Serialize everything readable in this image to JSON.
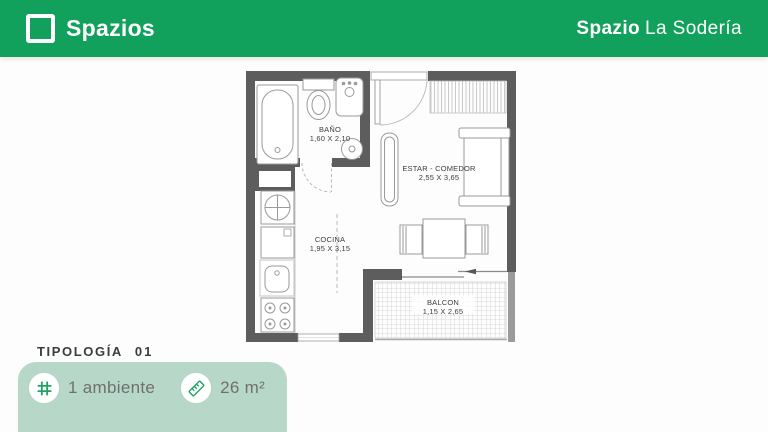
{
  "header": {
    "brand": "Spazios",
    "project_prefix": "Spazio",
    "project_name": "La Sodería",
    "background_color": "#12a05d"
  },
  "floor_plan": {
    "wall_color": "#5d5d5d",
    "line_color": "#9a9a9a",
    "rooms": [
      {
        "name": "BAÑO",
        "dims": "1,60 X 2,10"
      },
      {
        "name": "ESTAR - COMEDOR",
        "dims": "2,55 X 3,65"
      },
      {
        "name": "COCINA",
        "dims": "1,95 X 3,15"
      },
      {
        "name": "BALCON",
        "dims": "1,15 X 2,65"
      }
    ]
  },
  "footer": {
    "typology_label": "TIPOLOGÍA",
    "typology_number": "01",
    "card_color": "#b7d8c9",
    "accent_color": "#1ea365",
    "features": [
      {
        "icon": "grid-icon",
        "label": "1 ambiente"
      },
      {
        "icon": "ruler-icon",
        "label": "26 m²"
      }
    ]
  }
}
